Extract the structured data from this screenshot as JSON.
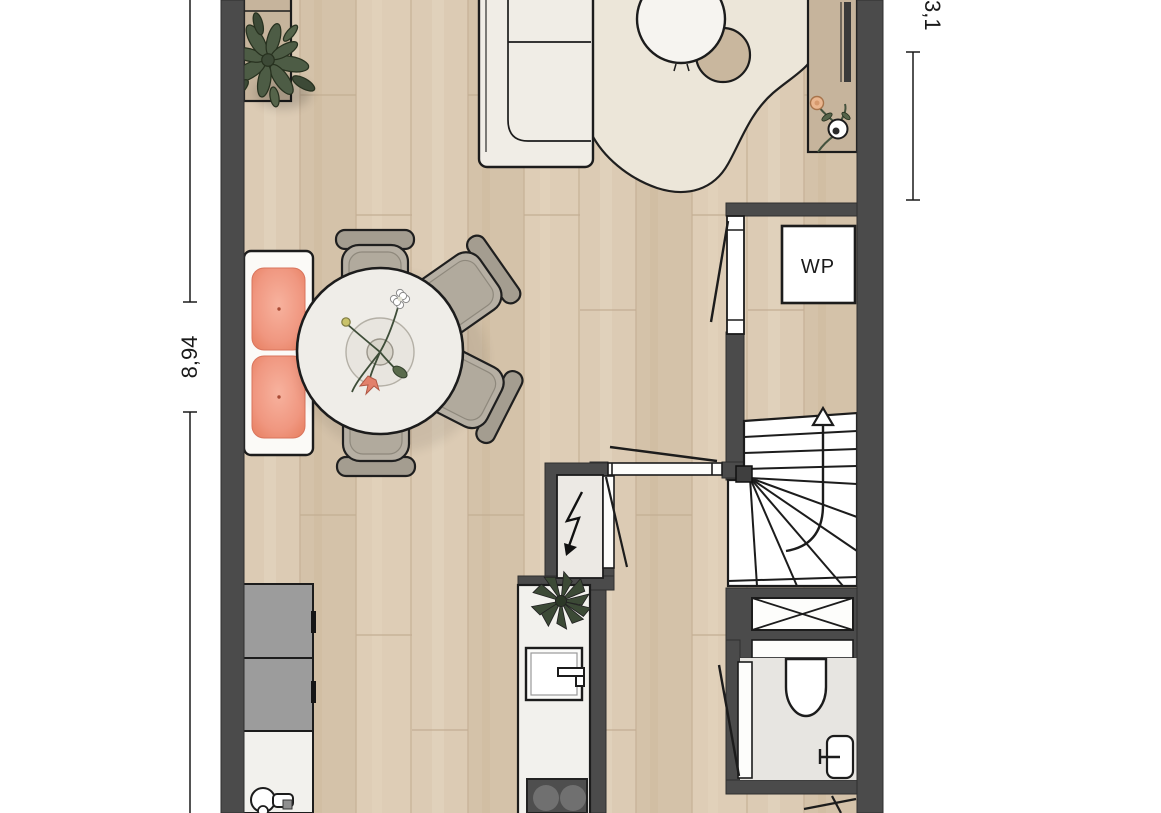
{
  "plan": {
    "annotations": {
      "heat_pump_label": "WP",
      "dimension_left": "8,94",
      "dimension_right": "3,1"
    },
    "palette": {
      "wall": "#4b4b4b",
      "floor_wood": "#d9c8b0",
      "plank_line": "#c7b298",
      "rug": "#ece6d9",
      "cushion_salmon": "#ef9379",
      "chair_gray": "#b6afa3",
      "chair_bar_gray": "#a49d90",
      "cabinet_tan": "#c6b49c",
      "kitchen_cabinet_gray": "#9c9c9c",
      "wet_room_floor": "#e7e5e1",
      "meter_cupboard_floor": "#ece9e4",
      "cooktop_dark": "#4e4e4e",
      "plant_green": "#4d5c45",
      "flower_peach": "#eab68f",
      "line_black": "#1c1c1c"
    },
    "objects": [
      "sofa",
      "area-rug",
      "coffee-table-round",
      "side-table-round",
      "tv-sideboard",
      "flower-vase",
      "plant-on-sideboard",
      "dining-bench",
      "bench-cushions",
      "dining-table-round",
      "table-flower-decoration",
      "dining-chairs",
      "heat-pump-unit",
      "interior-door",
      "glass-partition-door",
      "winder-staircase",
      "stairs-up-arrow",
      "duct-shaft",
      "shelf-sill",
      "toilet",
      "hand-basin",
      "toilet-door",
      "meter-cupboard",
      "electric-meter-arrow",
      "kitchen-tall-cabinets",
      "kitchen-counter",
      "kitchen-faucet",
      "island-counter",
      "island-sink",
      "island-plant",
      "cooktop",
      "entrance-door-swing",
      "dimension-line-left",
      "dimension-line-right"
    ]
  }
}
